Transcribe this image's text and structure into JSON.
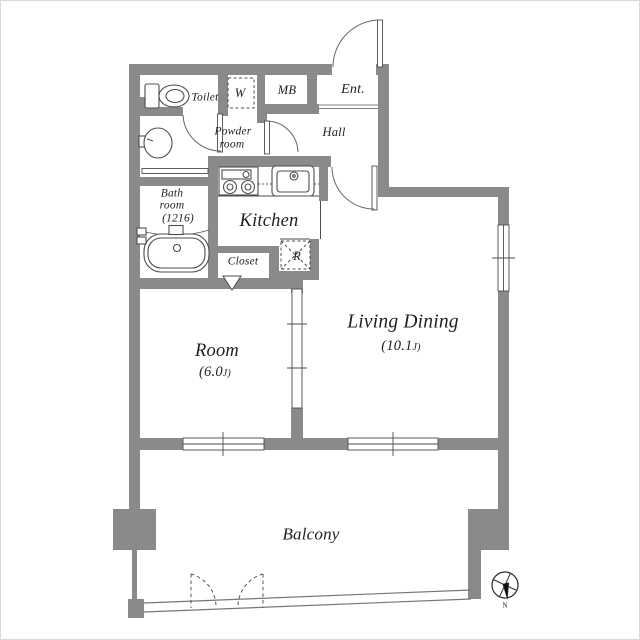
{
  "rooms": {
    "toilet": {
      "label": "Toilet"
    },
    "washer": {
      "label": "W"
    },
    "meter_box": {
      "label": "MB"
    },
    "entrance": {
      "label": "Ent."
    },
    "hall": {
      "label": "Hall"
    },
    "powder_room": {
      "line1": "Powder",
      "line2": "room"
    },
    "bath_room": {
      "line1": "Bath",
      "line2": "room",
      "line3": "(1216)"
    },
    "kitchen": {
      "label": "Kitchen"
    },
    "closet": {
      "label": "Closet"
    },
    "refrigerator": {
      "label": "R"
    },
    "bedroom": {
      "label": "Room",
      "area_value": "(6.0",
      "area_unit": "J)"
    },
    "living_dining": {
      "label": "Living Dining",
      "area_value": "(10.1",
      "area_unit": "J)"
    },
    "balcony": {
      "label": "Balcony"
    }
  },
  "compass": {
    "north_label": "N"
  },
  "colors": {
    "wall": "#8a8a8a",
    "line": "#4d4d4d",
    "background": "#ffffff"
  }
}
